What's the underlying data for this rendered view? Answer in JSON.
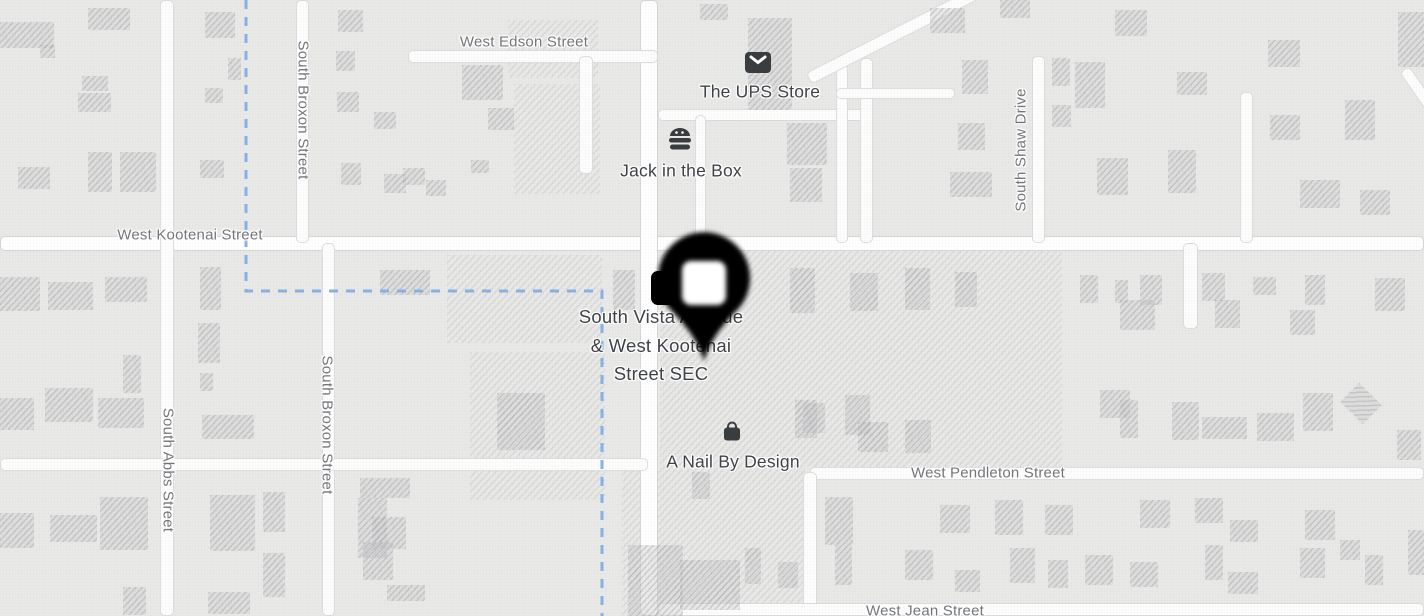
{
  "map": {
    "background_color": "#e9e9e8",
    "boundary_line": {
      "path": "M246 0 L246 291 L602 291 L602 616",
      "color": "#8ab1e8"
    },
    "marker": {
      "label": "dropped-pin",
      "x": 704,
      "y": 361
    },
    "street_labels": [
      {
        "text": "West Edson Street",
        "x": 524,
        "y": 42,
        "dir": "h"
      },
      {
        "text": "West Kootenai Street",
        "x": 190,
        "y": 235,
        "dir": "h"
      },
      {
        "text": "West Pendleton Street",
        "x": 988,
        "y": 473,
        "dir": "h"
      },
      {
        "text": "West Jean Street",
        "x": 925,
        "y": 611,
        "dir": "h"
      },
      {
        "text": "South Broxon Street",
        "x": 303,
        "y": 110,
        "dir": "v-down"
      },
      {
        "text": "South Broxon Street",
        "x": 327,
        "y": 425,
        "dir": "v-down"
      },
      {
        "text": "South Abbs Street",
        "x": 168,
        "y": 470,
        "dir": "v-down"
      },
      {
        "text": "South Shaw Drive",
        "x": 1021,
        "y": 150,
        "dir": "v-up"
      }
    ],
    "poi_labels": [
      {
        "name": "The UPS Store",
        "icon": "mail-icon",
        "x": 760,
        "y": 92,
        "ix": 758,
        "iy": 62
      },
      {
        "name": "Jack in the Box",
        "icon": "burger-icon",
        "x": 681,
        "y": 171,
        "ix": 680,
        "iy": 139
      },
      {
        "name": "A Nail By Design",
        "icon": "shopping-bag-icon",
        "x": 733,
        "y": 462,
        "ix": 732,
        "iy": 431
      },
      {
        "name": "South Vista Avenue & West Kootenai Street SEC",
        "icon": "store-icon",
        "lines": [
          "South Vista Avenue",
          "& West Kootenai",
          "Street SEC"
        ],
        "x": 661,
        "y": 303,
        "ix": 670,
        "iy": 288
      }
    ],
    "roads": [
      {
        "x": 0,
        "y": 236,
        "w": 1424,
        "h": 15,
        "major": true
      },
      {
        "x": 640,
        "y": 0,
        "w": 18,
        "h": 616,
        "major": true
      },
      {
        "x": 160,
        "y": 0,
        "w": 14,
        "h": 616
      },
      {
        "x": 296,
        "y": 0,
        "w": 13,
        "h": 243
      },
      {
        "x": 322,
        "y": 243,
        "w": 13,
        "h": 373
      },
      {
        "x": 408,
        "y": 50,
        "w": 250,
        "h": 13
      },
      {
        "x": 579,
        "y": 56,
        "w": 14,
        "h": 118
      },
      {
        "x": 0,
        "y": 458,
        "w": 648,
        "h": 13
      },
      {
        "x": 658,
        "y": 109,
        "w": 212,
        "h": 12
      },
      {
        "x": 695,
        "y": 115,
        "w": 11,
        "h": 128
      },
      {
        "x": 860,
        "y": 58,
        "w": 13,
        "h": 185
      },
      {
        "x": 836,
        "y": 55,
        "w": 12,
        "h": 188
      },
      {
        "x": 836,
        "y": 88,
        "w": 119,
        "h": 11
      },
      {
        "x": 1032,
        "y": 56,
        "w": 13,
        "h": 187
      },
      {
        "x": 1240,
        "y": 92,
        "w": 13,
        "h": 151
      },
      {
        "x": 1183,
        "y": 243,
        "w": 15,
        "h": 86
      },
      {
        "x": 810,
        "y": 467,
        "w": 614,
        "h": 13
      },
      {
        "x": 803,
        "y": 472,
        "w": 14,
        "h": 144
      },
      {
        "x": 658,
        "y": 603,
        "w": 766,
        "h": 13
      },
      {
        "x": 798,
        "y": 28,
        "w": 195,
        "h": 13,
        "rot": -27
      },
      {
        "x": 1385,
        "y": 100,
        "w": 90,
        "h": 12,
        "rot": 55
      }
    ],
    "parcels": [
      {
        "x": 508,
        "y": 20,
        "w": 90,
        "h": 58
      },
      {
        "x": 514,
        "y": 84,
        "w": 86,
        "h": 110
      },
      {
        "x": 447,
        "y": 255,
        "w": 155,
        "h": 88
      },
      {
        "x": 470,
        "y": 352,
        "w": 135,
        "h": 148
      },
      {
        "x": 660,
        "y": 250,
        "w": 402,
        "h": 217
      },
      {
        "x": 622,
        "y": 467,
        "w": 183,
        "h": 149
      }
    ],
    "buildings": [
      [
        0,
        22,
        54,
        26
      ],
      [
        40,
        45,
        15,
        13
      ],
      [
        88,
        8,
        42,
        22
      ],
      [
        205,
        12,
        30,
        26
      ],
      [
        228,
        58,
        13,
        22
      ],
      [
        82,
        76,
        26,
        15
      ],
      [
        78,
        93,
        33,
        19
      ],
      [
        205,
        88,
        18,
        15
      ],
      [
        18,
        167,
        32,
        22
      ],
      [
        88,
        152,
        24,
        40
      ],
      [
        120,
        152,
        36,
        40
      ],
      [
        200,
        160,
        24,
        18
      ],
      [
        338,
        10,
        25,
        22
      ],
      [
        336,
        51,
        19,
        20
      ],
      [
        337,
        92,
        22,
        20
      ],
      [
        374,
        112,
        22,
        17
      ],
      [
        341,
        163,
        20,
        22
      ],
      [
        384,
        174,
        22,
        19
      ],
      [
        426,
        180,
        20,
        16
      ],
      [
        462,
        65,
        41,
        35
      ],
      [
        488,
        108,
        26,
        22
      ],
      [
        471,
        160,
        18,
        13
      ],
      [
        403,
        168,
        22,
        17
      ],
      [
        700,
        4,
        28,
        16
      ],
      [
        748,
        18,
        44,
        92
      ],
      [
        787,
        123,
        40,
        42
      ],
      [
        790,
        168,
        32,
        34
      ],
      [
        930,
        8,
        35,
        25
      ],
      [
        1000,
        0,
        30,
        18
      ],
      [
        962,
        60,
        26,
        34
      ],
      [
        1052,
        58,
        18,
        28
      ],
      [
        1052,
        105,
        19,
        22
      ],
      [
        958,
        123,
        27,
        27
      ],
      [
        950,
        172,
        42,
        25
      ],
      [
        1075,
        62,
        30,
        46
      ],
      [
        1097,
        158,
        31,
        37
      ],
      [
        1115,
        10,
        32,
        26
      ],
      [
        1177,
        72,
        30,
        23
      ],
      [
        1168,
        150,
        28,
        43
      ],
      [
        1268,
        40,
        32,
        27
      ],
      [
        1270,
        115,
        30,
        25
      ],
      [
        1345,
        100,
        30,
        40
      ],
      [
        1398,
        12,
        26,
        55
      ],
      [
        1300,
        180,
        40,
        28
      ],
      [
        1360,
        190,
        30,
        25
      ],
      [
        0,
        277,
        40,
        34
      ],
      [
        48,
        282,
        45,
        28
      ],
      [
        105,
        277,
        42,
        25
      ],
      [
        0,
        398,
        34,
        32
      ],
      [
        45,
        388,
        48,
        34
      ],
      [
        98,
        398,
        46,
        30
      ],
      [
        123,
        355,
        18,
        38
      ],
      [
        0,
        513,
        34,
        35
      ],
      [
        50,
        515,
        47,
        27
      ],
      [
        100,
        497,
        48,
        53
      ],
      [
        123,
        587,
        23,
        28
      ],
      [
        200,
        267,
        21,
        43
      ],
      [
        198,
        323,
        22,
        40
      ],
      [
        200,
        373,
        13,
        18
      ],
      [
        202,
        415,
        52,
        24
      ],
      [
        210,
        495,
        45,
        56
      ],
      [
        263,
        492,
        22,
        40
      ],
      [
        208,
        592,
        42,
        22
      ],
      [
        263,
        553,
        22,
        44
      ],
      [
        360,
        478,
        50,
        20
      ],
      [
        358,
        498,
        29,
        60
      ],
      [
        372,
        517,
        34,
        32
      ],
      [
        363,
        542,
        30,
        38
      ],
      [
        387,
        585,
        38,
        16
      ],
      [
        380,
        270,
        50,
        25
      ],
      [
        497,
        393,
        48,
        57
      ],
      [
        613,
        270,
        22,
        40
      ],
      [
        790,
        268,
        25,
        45
      ],
      [
        850,
        273,
        28,
        38
      ],
      [
        905,
        268,
        25,
        42
      ],
      [
        955,
        272,
        22,
        35
      ],
      [
        1080,
        275,
        18,
        28
      ],
      [
        1115,
        280,
        13,
        23
      ],
      [
        1140,
        275,
        22,
        30
      ],
      [
        1202,
        273,
        23,
        28
      ],
      [
        1253,
        277,
        23,
        18
      ],
      [
        1305,
        275,
        20,
        30
      ],
      [
        1375,
        278,
        30,
        33
      ],
      [
        1120,
        300,
        35,
        30
      ],
      [
        1215,
        300,
        25,
        28
      ],
      [
        1290,
        310,
        25,
        25
      ],
      [
        795,
        400,
        22,
        38
      ],
      [
        845,
        395,
        25,
        40
      ],
      [
        905,
        420,
        26,
        33
      ],
      [
        858,
        422,
        30,
        30
      ],
      [
        803,
        403,
        22,
        30
      ],
      [
        1100,
        390,
        30,
        28
      ],
      [
        1120,
        400,
        18,
        38
      ],
      [
        1172,
        402,
        27,
        38
      ],
      [
        1202,
        417,
        45,
        22
      ],
      [
        1257,
        413,
        37,
        28
      ],
      [
        1303,
        393,
        30,
        38
      ],
      [
        1345,
        390,
        32,
        27,
        45
      ],
      [
        1397,
        430,
        24,
        30
      ],
      [
        692,
        472,
        18,
        27
      ],
      [
        825,
        497,
        28,
        48
      ],
      [
        940,
        505,
        30,
        28
      ],
      [
        995,
        500,
        28,
        35
      ],
      [
        1045,
        505,
        28,
        30
      ],
      [
        1140,
        500,
        30,
        28
      ],
      [
        1195,
        498,
        28,
        25
      ],
      [
        1230,
        520,
        28,
        22
      ],
      [
        1305,
        510,
        30,
        30
      ],
      [
        628,
        545,
        55,
        71
      ],
      [
        680,
        560,
        60,
        50
      ],
      [
        745,
        548,
        16,
        36
      ],
      [
        778,
        562,
        20,
        26
      ],
      [
        835,
        545,
        17,
        40
      ],
      [
        905,
        550,
        28,
        30
      ],
      [
        955,
        570,
        25,
        22
      ],
      [
        1010,
        548,
        25,
        35
      ],
      [
        1048,
        560,
        20,
        28
      ],
      [
        1085,
        555,
        28,
        30
      ],
      [
        1130,
        562,
        28,
        25
      ],
      [
        1205,
        545,
        18,
        35
      ],
      [
        1228,
        572,
        30,
        22
      ],
      [
        1300,
        548,
        25,
        30
      ],
      [
        1340,
        540,
        20,
        20
      ],
      [
        1365,
        555,
        18,
        30
      ],
      [
        1408,
        530,
        16,
        45
      ]
    ]
  }
}
